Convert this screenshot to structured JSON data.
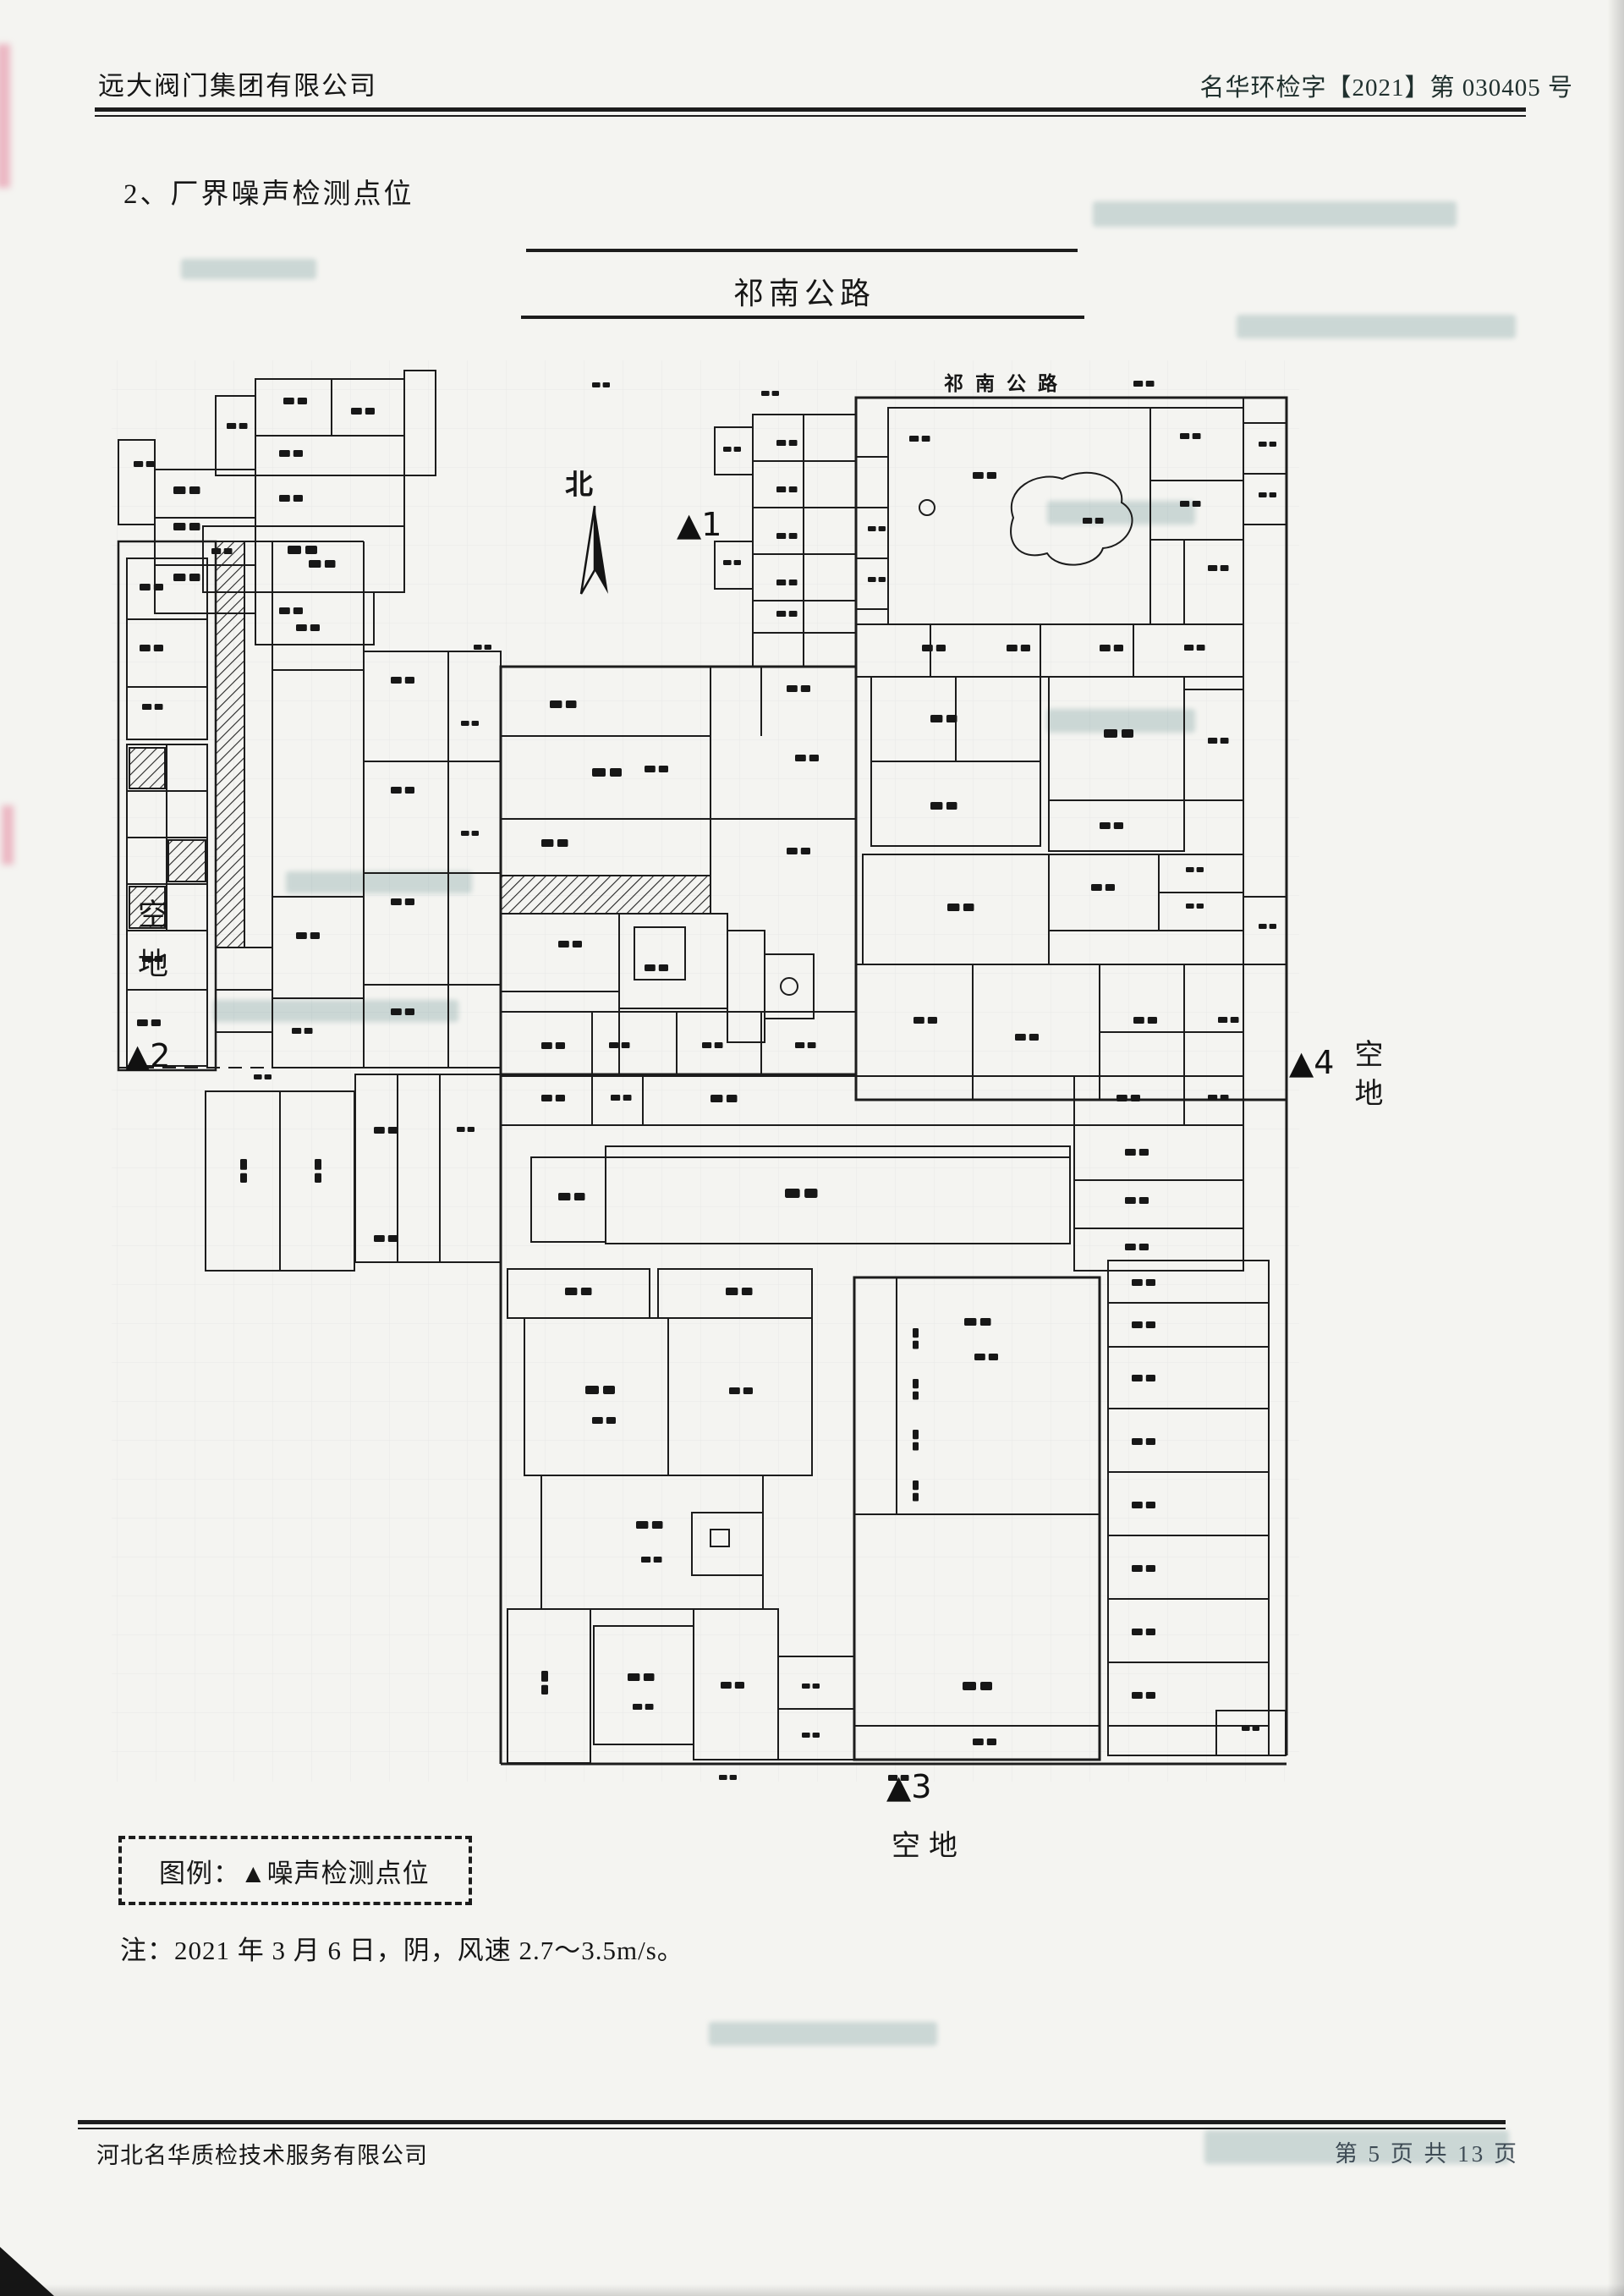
{
  "header": {
    "company_name": "远大阀门集团有限公司",
    "document_number": "名华环检字【2021】第 030405 号"
  },
  "section_title": "2、厂界噪声检测点位",
  "site_plan": {
    "road_name_top": "祁南公路",
    "road_name_in_plan": "祁南公路",
    "north_label": "北",
    "vacant_land_left": "空地",
    "vacant_land_right": "空地",
    "vacant_land_bottom": "空地",
    "noise_points": [
      {
        "label": "▲1"
      },
      {
        "label": "▲2"
      },
      {
        "label": "▲3"
      },
      {
        "label": "▲4"
      }
    ]
  },
  "legend": {
    "text": "图例：▲噪声检测点位"
  },
  "note": "注：2021 年 3 月 6 日，阴，风速 2.7～3.5m/s。",
  "footer": {
    "company_name": "河北名华质检技术服务有限公司",
    "page_info": "第 5 页 共 13 页"
  }
}
